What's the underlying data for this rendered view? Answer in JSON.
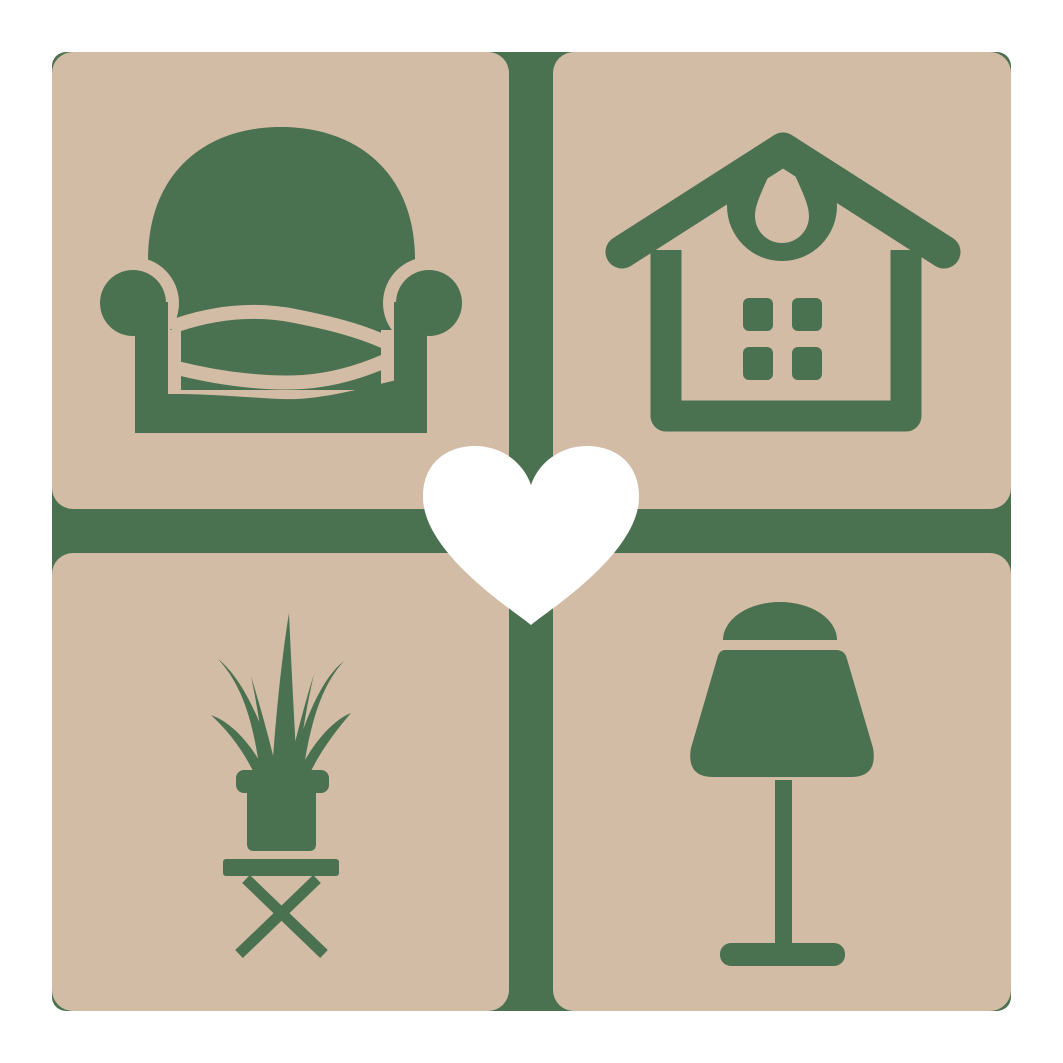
{
  "logo": {
    "description": "Home decor brand mark: four rounded tiles with furniture icons around a central heart",
    "colors": {
      "background": "#FFFFFF",
      "tile": "#D3BCA6",
      "icon": "#4A7150",
      "heart": "#FFFFFF"
    },
    "tiles": [
      {
        "position": "top-left",
        "icon": "armchair-icon"
      },
      {
        "position": "top-right",
        "icon": "house-icon"
      },
      {
        "position": "bottom-left",
        "icon": "potted-plant-icon"
      },
      {
        "position": "bottom-right",
        "icon": "table-lamp-icon"
      }
    ],
    "center": {
      "icon": "heart-icon"
    }
  }
}
